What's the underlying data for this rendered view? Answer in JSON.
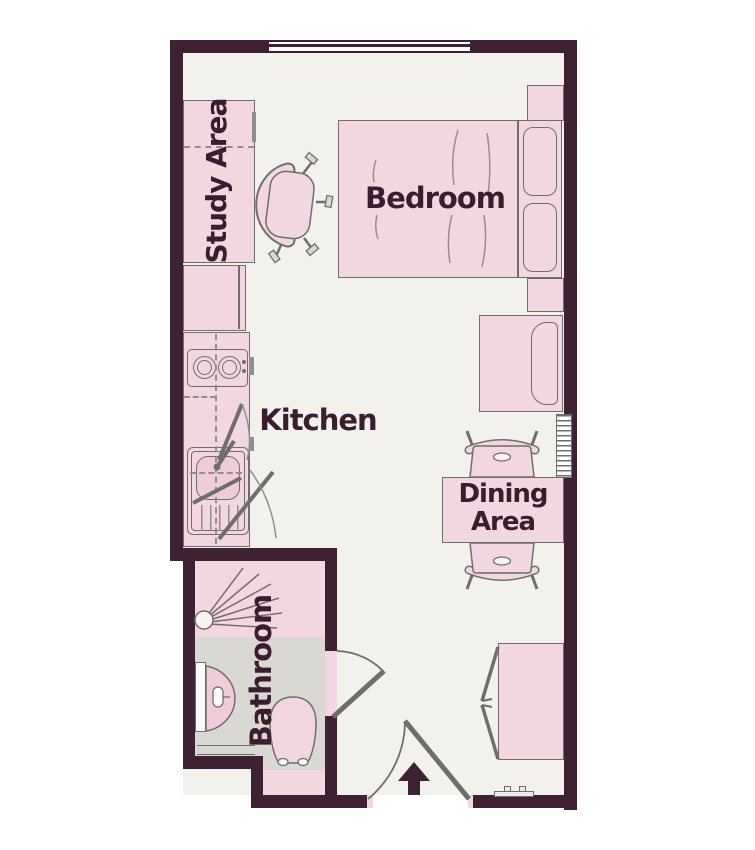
{
  "floorplan": {
    "title": "Studio apartment floor plan",
    "rooms": {
      "study": {
        "label": "Study Area"
      },
      "bedroom": {
        "label": "Bedroom"
      },
      "kitchen": {
        "label": "Kitchen"
      },
      "dining": {
        "label": "Dining Area",
        "line1": "Dining",
        "line2": "Area"
      },
      "bathroom": {
        "label": "Bathroom"
      }
    },
    "icons": {
      "entrance_arrow": "up-arrow",
      "shower_head": "spray-fan",
      "door_swing": "quarter-arc"
    },
    "colors": {
      "wall": "#3e2133",
      "label_text": "#3a1d2e",
      "furniture_pink": "#f2d7e0",
      "basin_pink": "#eeccd9",
      "floor": "#f3f1ec",
      "bathroom_floor": "#d9d8d3",
      "outline_gray": "#6e6e6e"
    }
  }
}
